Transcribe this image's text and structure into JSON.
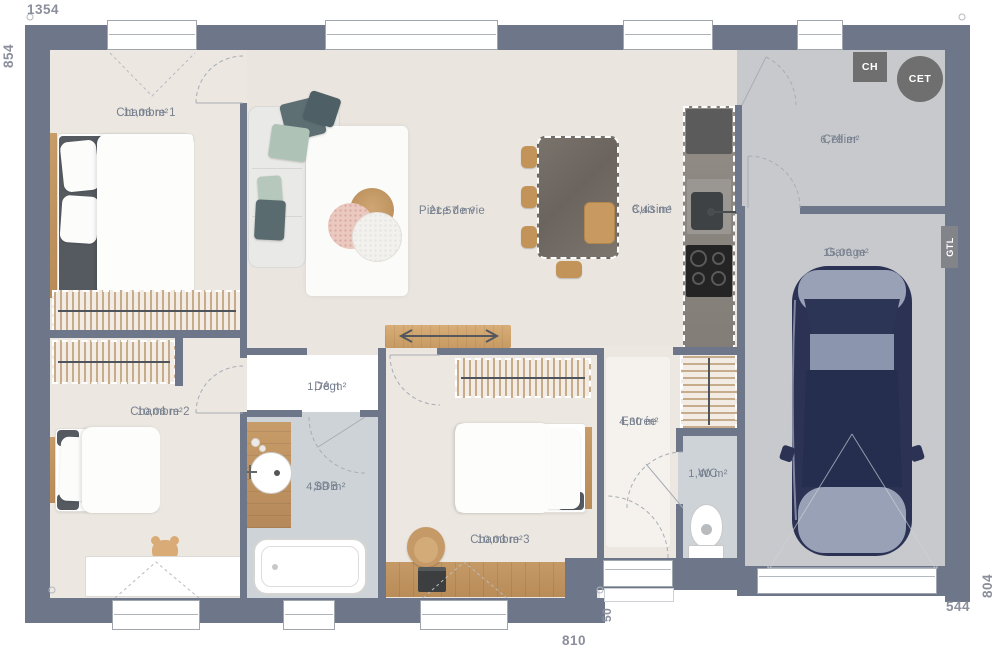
{
  "plan": {
    "dimensions": {
      "top": "1354",
      "left": "854",
      "right": "804",
      "bottom": "810",
      "bottom_right": "544",
      "entrance_step": "50"
    },
    "rooms": [
      {
        "name": "Chambre 1",
        "area": "11,06 m²"
      },
      {
        "name": "Chambre 2",
        "area": "10,06 m²"
      },
      {
        "name": "Chambre 3",
        "area": "10,03 m²"
      },
      {
        "name": "Pièce de vie",
        "area": "21,57 m²"
      },
      {
        "name": "Cuisine",
        "area": "8,43 m²"
      },
      {
        "name": "Cellier",
        "area": "6,78 m²"
      },
      {
        "name": "Garage",
        "area": "15,00 m²"
      },
      {
        "name": "Dégt",
        "area": "1,78 m²"
      },
      {
        "name": "SDB",
        "area": "4,89 m²"
      },
      {
        "name": "Entrée",
        "area": "4,30 m²"
      },
      {
        "name": "WC",
        "area": "1,40 m²"
      }
    ],
    "equipment": {
      "ch_label": "CH",
      "cet_label": "CET",
      "gtl_label": "GTL"
    },
    "colors": {
      "wall": "#6e7789",
      "floor_main": "#eae5df",
      "floor_bedroom": "#ece7e1",
      "floor_wet": "#cdd3d6",
      "floor_utility": "#c7c9cc",
      "window_frame": "#a0a6ad",
      "appliance": "#6f6f6f",
      "label": "#78818f",
      "dimension": "#8a8f9b",
      "wood": "#bf9464",
      "table_stone": "#6f6862",
      "car_body": "#2b3254",
      "car_light": "#99a1b7",
      "car_mid": "#8c95ae"
    }
  }
}
